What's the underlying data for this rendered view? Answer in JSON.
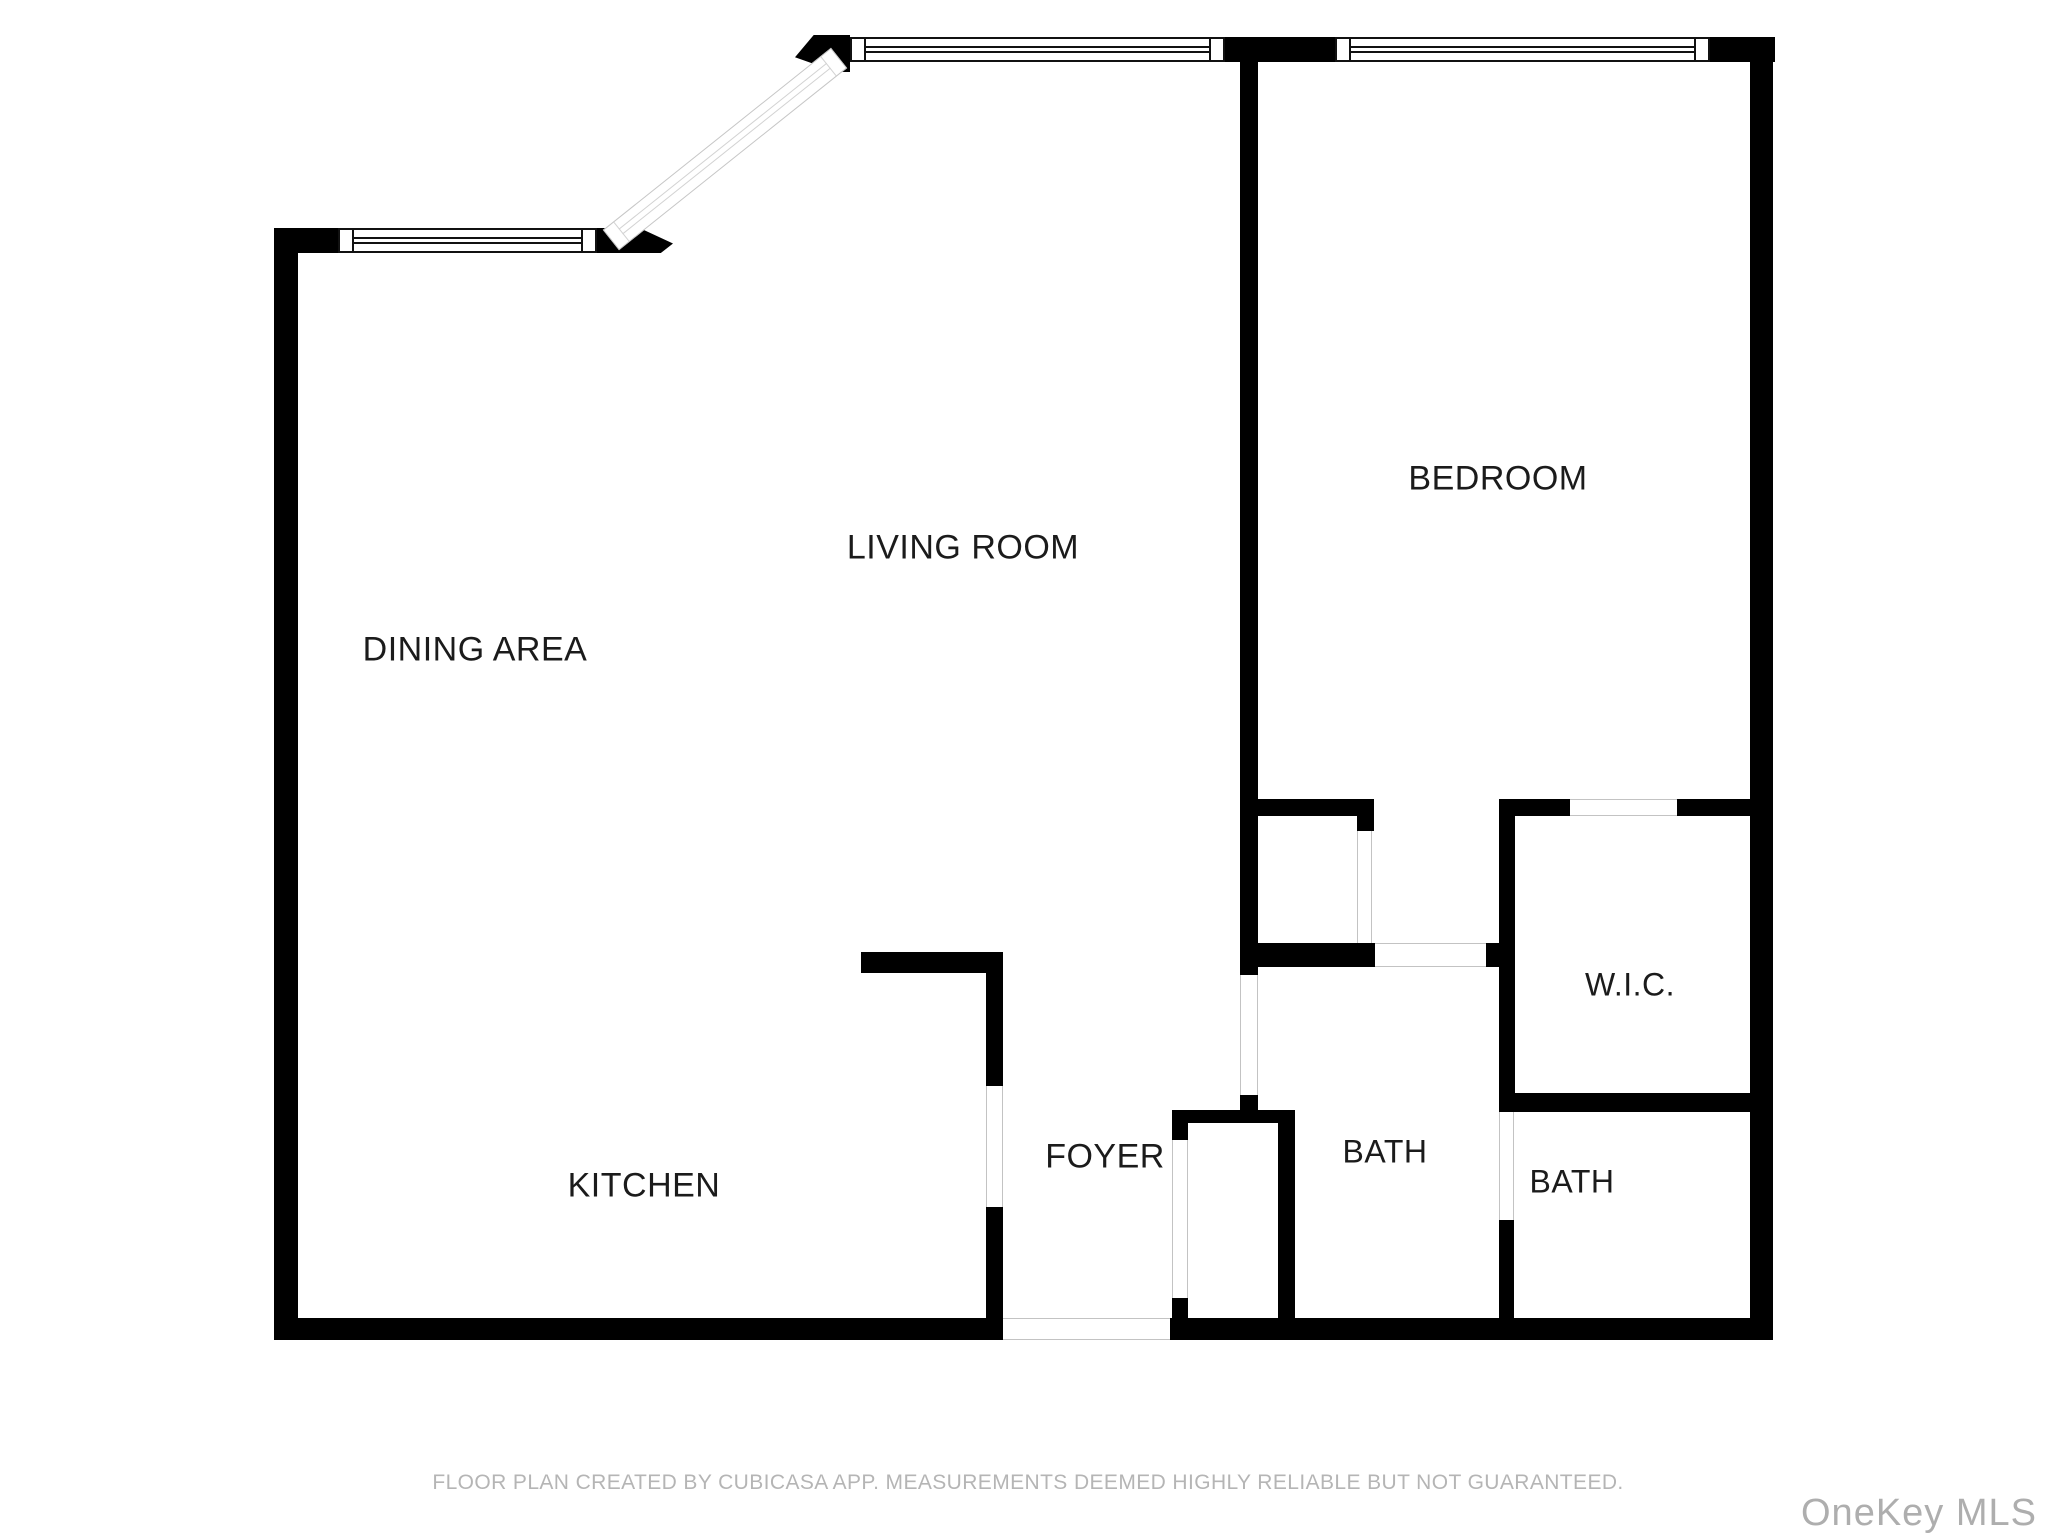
{
  "plan": {
    "rooms": [
      {
        "label": "DINING AREA"
      },
      {
        "label": "LIVING ROOM"
      },
      {
        "label": "BEDROOM"
      },
      {
        "label": "KITCHEN"
      },
      {
        "label": "FOYER"
      },
      {
        "label": "BATH"
      },
      {
        "label": "BATH"
      },
      {
        "label": "W.I.C."
      }
    ]
  },
  "footer": {
    "disclaimer": "FLOOR PLAN CREATED BY CUBICASA APP. MEASUREMENTS DEEMED HIGHLY RELIABLE BUT NOT GUARANTEED."
  },
  "watermark": {
    "text": "OneKey MLS"
  },
  "colors": {
    "wall": "#000000",
    "label": "#1b1b1b",
    "footer": "#b5b5b5",
    "watermark": "#aeaeae",
    "opening_jamb": "#c3c3c3"
  }
}
